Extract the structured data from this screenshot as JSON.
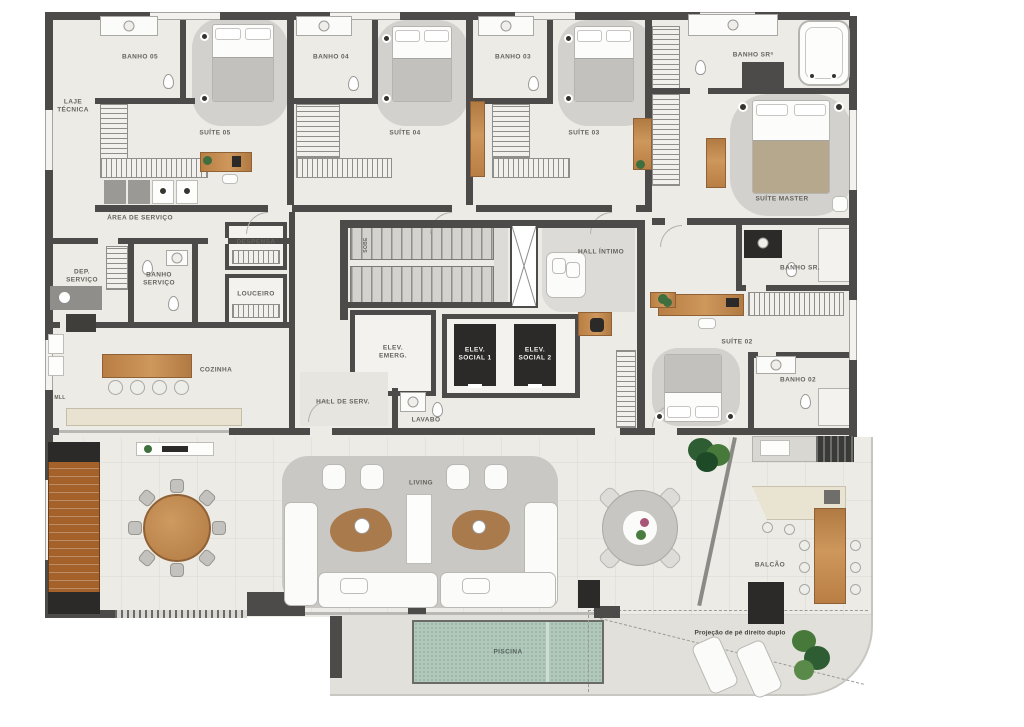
{
  "labels": {
    "laje_tecnica": "LAJE TÉCNICA",
    "banho_05": "BANHO 05",
    "suite_05": "SUÍTE 05",
    "banho_04": "BANHO 04",
    "suite_04": "SUÍTE 04",
    "banho_03": "BANHO 03",
    "suite_03": "SUÍTE 03",
    "banho_sra": "BANHO SRª",
    "suite_master": "SUÍTE MASTER",
    "area_servico": "ÁREA DE SERVIÇO",
    "dep_servico": "DEP. SERVIÇO",
    "banho_servico": "BANHO SERVIÇO",
    "despensa": "DESPENSA",
    "louceiro": "LOUCEIRO",
    "cozinha": "COZINHA",
    "mll": "MLL",
    "sobe": "SOBE",
    "elev_emerg": "ELEV. EMERG.",
    "elev_social_1": "ELEV. SOCIAL 1",
    "elev_social_2": "ELEV. SOCIAL 2",
    "hall_serv": "HALL DE SERV.",
    "lavabo": "LAVABO",
    "hall_intimo": "HALL ÍNTIMO",
    "banho_sr": "BANHO SR.",
    "suite_02": "SUÍTE 02",
    "banho_02": "BANHO 02",
    "living": "LIVING",
    "balcao": "BALCÃO",
    "piscina": "PISCINA",
    "projecao": "Projeção de pé direito duplo"
  },
  "colors": {
    "wall": "#4c4b49",
    "floor": "#edebe6",
    "rug": "#d2d1cd",
    "deck": "#e2e0da",
    "wood": "#c0874b",
    "adega": "#a4622a",
    "pool": "#b2c8bb",
    "dark": "#2b2a28"
  }
}
